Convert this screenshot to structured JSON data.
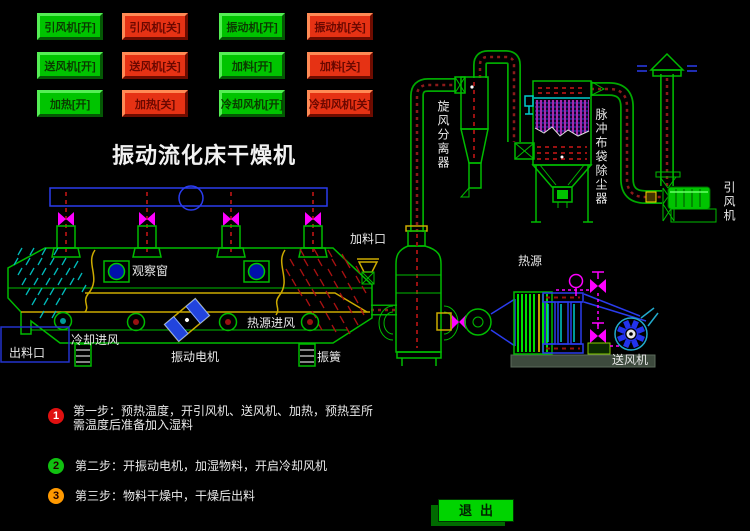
{
  "title": "振动流化床干燥机",
  "controls": {
    "buttons": [
      {
        "label": "引风机[开]",
        "state": "on"
      },
      {
        "label": "引风机[关]",
        "state": "off"
      },
      {
        "label": "振动机[开]",
        "state": "on"
      },
      {
        "label": "振动机[关]",
        "state": "off"
      },
      {
        "label": "送风机[开]",
        "state": "on"
      },
      {
        "label": "送风机[关]",
        "state": "off"
      },
      {
        "label": "加料[开]",
        "state": "on"
      },
      {
        "label": "加料[关]",
        "state": "off"
      },
      {
        "label": "加热[开]",
        "state": "on"
      },
      {
        "label": "加热[关]",
        "state": "off"
      },
      {
        "label": "冷却风机[开]",
        "state": "on"
      },
      {
        "label": "冷却风机[关]",
        "state": "off"
      }
    ]
  },
  "diagram": {
    "labels": {
      "observation_window": "观察窗",
      "feed_inlet": "加料口",
      "cooling_air": "冷却进风",
      "heat_air": "热源进风",
      "discharge": "出料口",
      "vib_motor": "振动电机",
      "vib_spring": "振簧",
      "cyclone": "旋风分离器",
      "bag_filter": "脉冲布袋除尘器",
      "id_fan": "引风机",
      "heat_source": "热源",
      "supply_fan": "送风机"
    }
  },
  "steps": [
    {
      "num": "1",
      "badge_color": "#e01010",
      "text": "第一步：预热温度，开引风机、送风机、加热，预热至所需温度后准备加入湿料"
    },
    {
      "num": "2",
      "badge_color": "#10c010",
      "text": "第二步：开振动电机，加湿物料，开启冷却风机"
    },
    {
      "num": "3",
      "badge_color": "#ff9900",
      "text": "第三步：物料干燥中，干燥后出料"
    }
  ],
  "exit_button": {
    "label": "退出"
  },
  "colors": {
    "background": "#000000",
    "button_on": "#00c400",
    "button_off": "#e63214",
    "pipe_green": "#00a800",
    "flow_red": "#8b1a1a",
    "valve_magenta": "#ff00ff",
    "header_blue": "#2a3cee",
    "label_white": "#e8e8e8"
  }
}
